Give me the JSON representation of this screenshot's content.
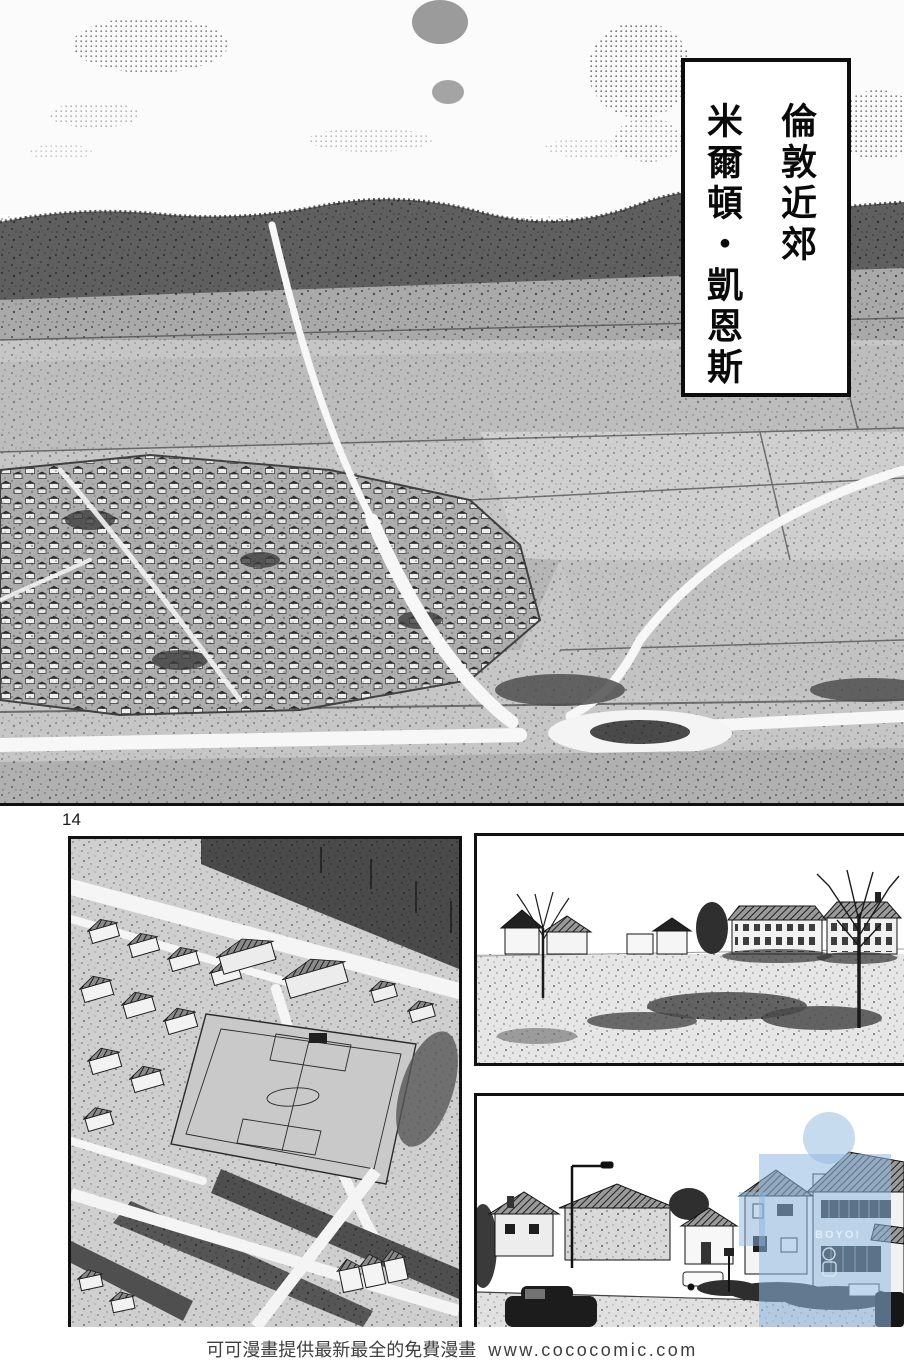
{
  "page": {
    "number": "14"
  },
  "caption_box": {
    "line1": "倫敦近郊",
    "line2": "米爾頓・凱恩斯"
  },
  "footer": {
    "site_text": "可可漫畫提供最新最全的免費漫畫",
    "site_url": "www.cococomic.com"
  },
  "watermark": {
    "text": "BOYO!",
    "color": "#8fb8e0"
  },
  "panels": {
    "main": {
      "desc": "Aerial view of open fields and hills with a town and road roundabout on the outskirts of London"
    },
    "estate": {
      "desc": "Aerial view of a housing estate surrounding a sports field"
    },
    "field": {
      "desc": "Open grass field with bare trees and a distant row of houses"
    },
    "street": {
      "desc": "Suburban street with detached houses, a street lamp and parked cars"
    }
  }
}
